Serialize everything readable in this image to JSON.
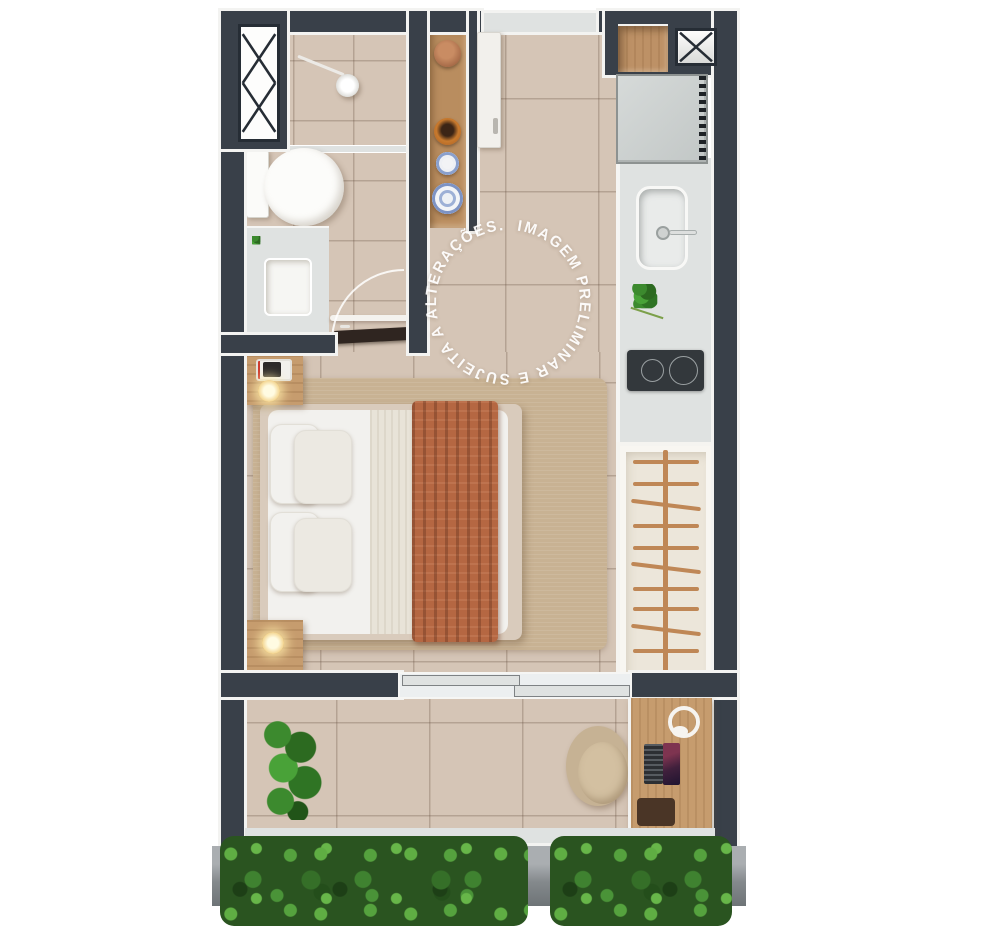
{
  "watermark": {
    "text": "IMAGEM PRELIMINAR E SUJEITA A ALTERAÇÕES.  ",
    "color": "#ffffff"
  },
  "palette": {
    "background": "#ffffff",
    "wall": "#394049",
    "wall_outline": "#f3f3f1",
    "floor_tile": "#d5c5b6",
    "granite": "#dfe2e1",
    "rug": "#c8b293",
    "wood": "#c69c6e",
    "bedding": "#f2f1ee",
    "throw": "#b56742",
    "hedge": "#2a5420",
    "planter": "#989da0",
    "cooktop": "#33383c",
    "fridge": "#ccd0cf",
    "wardrobe": "#ece6da",
    "hanger": "#bf8756"
  }
}
